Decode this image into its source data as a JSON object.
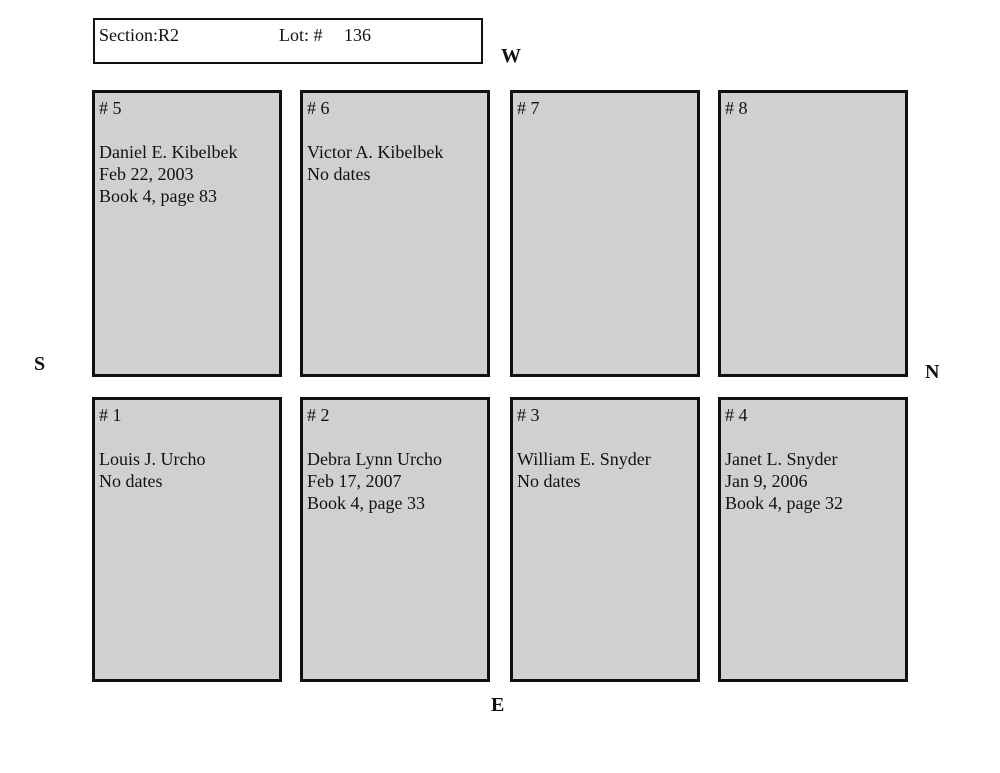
{
  "header": {
    "section_label": "Section:",
    "section_value": "R2",
    "lot_label": "Lot: #",
    "lot_value": "136"
  },
  "compass": {
    "west": "W",
    "south": "S",
    "north": "N",
    "east": "E"
  },
  "plots": {
    "p1": {
      "label": "# 1",
      "lines": [
        "Louis J. Urcho",
        "No dates"
      ]
    },
    "p2": {
      "label": "# 2",
      "lines": [
        "Debra Lynn Urcho",
        "Feb 17, 2007",
        "Book 4, page 33"
      ]
    },
    "p3": {
      "label": "# 3",
      "lines": [
        "William E. Snyder",
        "No dates"
      ]
    },
    "p4": {
      "label": "# 4",
      "lines": [
        "Janet L. Snyder",
        "Jan 9, 2006",
        "Book 4, page 32"
      ]
    },
    "p5": {
      "label": "# 5",
      "lines": [
        "Daniel E. Kibelbek",
        "Feb 22, 2003",
        "Book 4, page 83"
      ]
    },
    "p6": {
      "label": "# 6",
      "lines": [
        "Victor A. Kibelbek",
        "No dates"
      ]
    },
    "p7": {
      "label": "# 7",
      "lines": []
    },
    "p8": {
      "label": "# 8",
      "lines": []
    }
  },
  "colors": {
    "plot_fill": "#d0d0d0",
    "border": "#111111",
    "background": "#ffffff"
  }
}
